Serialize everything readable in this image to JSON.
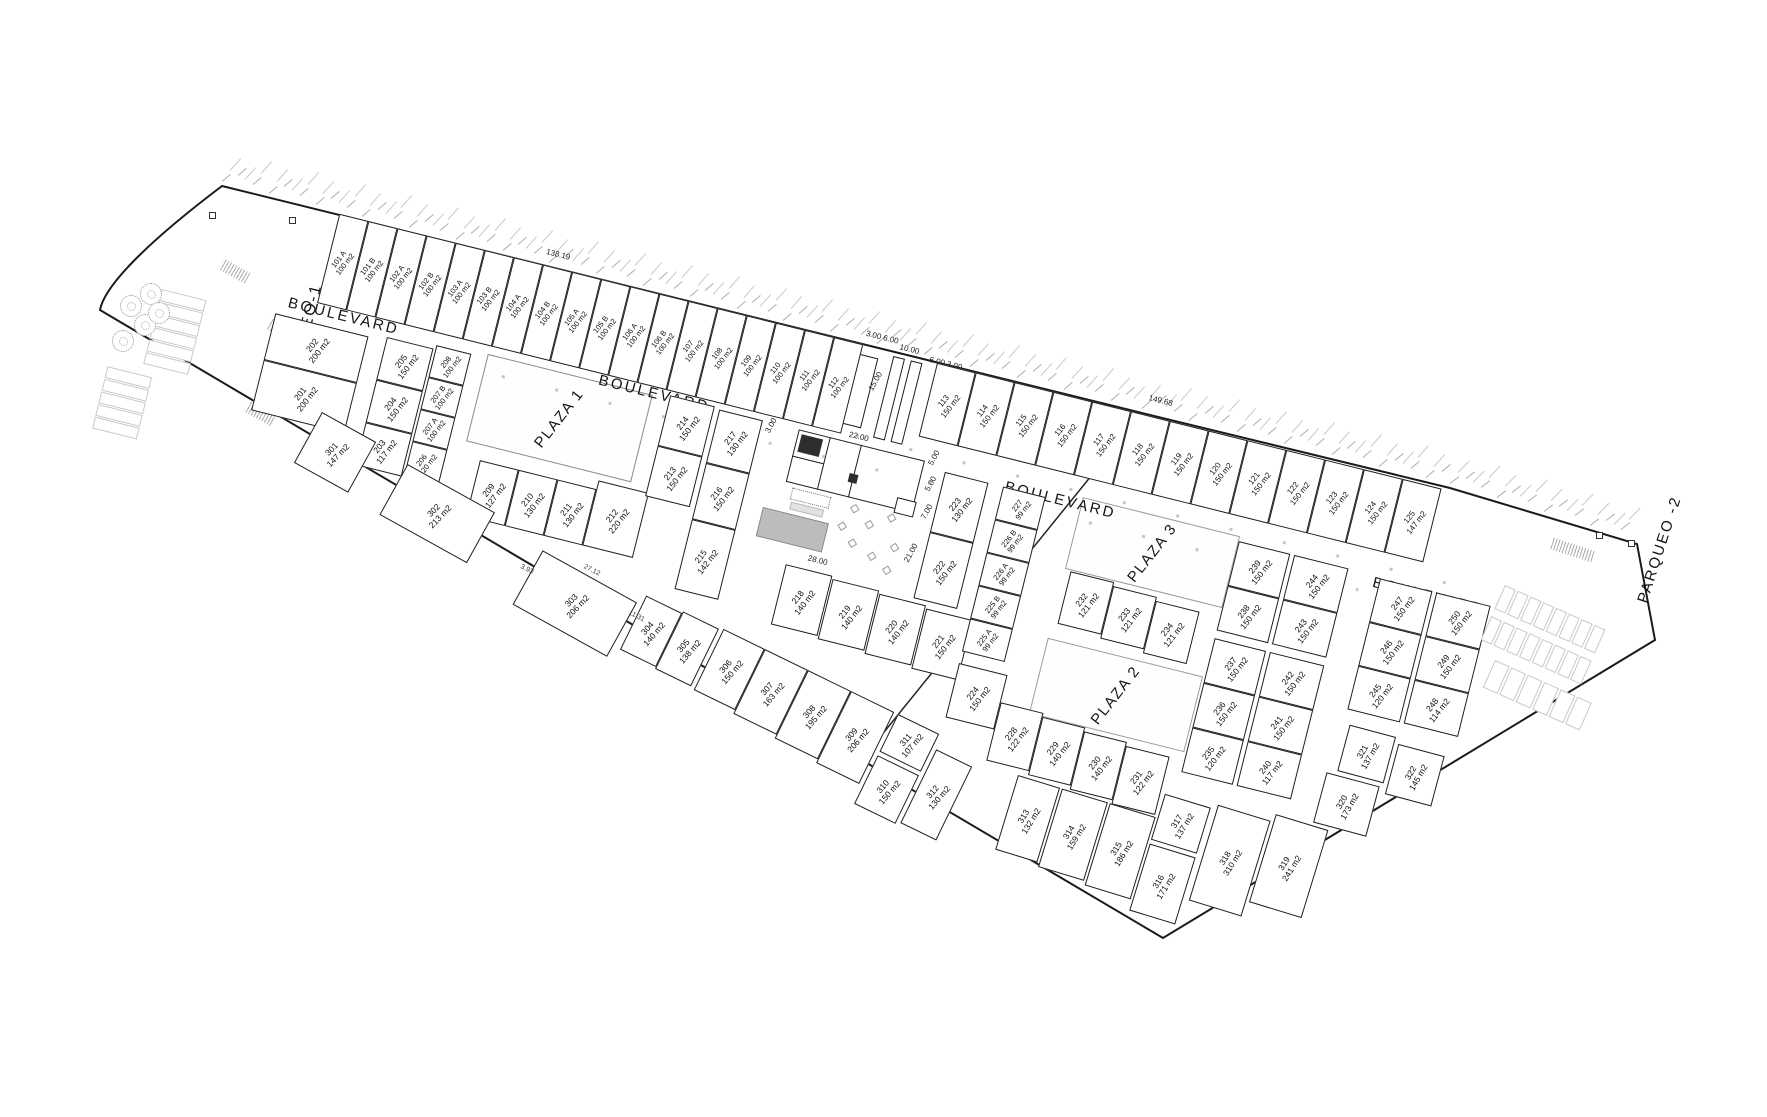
{
  "labels": {
    "parqueo1": "PARQUEO-1",
    "parqueo2": "PARQUEO -2",
    "boulevard": "BOULEVARD",
    "plaza1": "PLAZA 1",
    "plaza2": "PLAZA 2",
    "plaza3": "PLAZA 3"
  },
  "dimensions": {
    "boundary_left": "138.19",
    "boundary_right": "149.68",
    "entrance_a": "3.00 6.00",
    "entrance_b": "10.00",
    "entrance_c": "6.00 3.00",
    "entrance_depth": "15.00",
    "amenity_top": "22.00",
    "amenity_left": "3.00",
    "amenity_r1": "5.00",
    "amenity_r2": "5.00",
    "amenity_r3": "7.00",
    "amenity_r4": "21.00",
    "amenity_bottom": "28.00",
    "south_a": "3.93",
    "south_b": "27.12",
    "south_c": "11.31"
  },
  "lot_groups": {
    "north_a": [
      {
        "id": "101 A",
        "area": "100 m2"
      },
      {
        "id": "101 B",
        "area": "100 m2"
      },
      {
        "id": "102 A",
        "area": "100 m2"
      },
      {
        "id": "102 B",
        "area": "100 m2"
      },
      {
        "id": "103 A",
        "area": "100 m2"
      },
      {
        "id": "103 B",
        "area": "100 m2"
      },
      {
        "id": "104 A",
        "area": "100 m2"
      },
      {
        "id": "104 B",
        "area": "100 m2"
      },
      {
        "id": "105 A",
        "area": "100 m2"
      },
      {
        "id": "105 B",
        "area": "100 m2"
      },
      {
        "id": "106 A",
        "area": "100 m2"
      },
      {
        "id": "106 B",
        "area": "100 m2"
      },
      {
        "id": "107",
        "area": "100 m2"
      },
      {
        "id": "108",
        "area": "100 m2"
      },
      {
        "id": "109",
        "area": "100 m2"
      },
      {
        "id": "110",
        "area": "100 m2"
      },
      {
        "id": "111",
        "area": "100 m2"
      },
      {
        "id": "112",
        "area": "100 m2"
      }
    ],
    "north_b": [
      {
        "id": "113",
        "area": "150 m2"
      },
      {
        "id": "114",
        "area": "150 m2"
      },
      {
        "id": "115",
        "area": "150 m2"
      },
      {
        "id": "116",
        "area": "150 m2"
      },
      {
        "id": "117",
        "area": "150 m2"
      },
      {
        "id": "118",
        "area": "150 m2"
      },
      {
        "id": "119",
        "area": "150 m2"
      },
      {
        "id": "120",
        "area": "150 m2"
      },
      {
        "id": "121",
        "area": "150 m2"
      },
      {
        "id": "122",
        "area": "150 m2"
      },
      {
        "id": "123",
        "area": "150 m2"
      },
      {
        "id": "124",
        "area": "150 m2"
      },
      {
        "id": "125",
        "area": "147 m2"
      }
    ],
    "b201": [
      {
        "id": "202",
        "area": "200 m2"
      },
      {
        "id": "201",
        "area": "200 m2"
      }
    ],
    "b203": [
      {
        "id": "205",
        "area": "150 m2"
      },
      {
        "id": "204",
        "area": "150 m2"
      },
      {
        "id": "203",
        "area": "117 m2"
      }
    ],
    "b206": [
      {
        "id": "208",
        "area": "100 m2"
      },
      {
        "id": "207 B",
        "area": "100 m2"
      },
      {
        "id": "207 A",
        "area": "100 m2"
      },
      {
        "id": "206",
        "area": "120 m2"
      }
    ],
    "b209": [
      {
        "id": "209",
        "area": "127 m2"
      },
      {
        "id": "210",
        "area": "130 m2"
      },
      {
        "id": "211",
        "area": "130 m2"
      },
      {
        "id": "212",
        "area": "220 m2"
      }
    ],
    "b213": [
      {
        "id": "214",
        "area": "150 m2"
      },
      {
        "id": "213",
        "area": "150 m2"
      }
    ],
    "b215": [
      {
        "id": "217",
        "area": "130 m2"
      },
      {
        "id": "216",
        "area": "150 m2"
      },
      {
        "id": "215",
        "area": "142 m2"
      }
    ],
    "b218": [
      {
        "id": "218",
        "area": "140 m2"
      },
      {
        "id": "219",
        "area": "140 m2"
      },
      {
        "id": "220",
        "area": "140 m2"
      },
      {
        "id": "221",
        "area": "150 m2"
      }
    ],
    "b222": [
      {
        "id": "223",
        "area": "130 m2"
      },
      {
        "id": "222",
        "area": "150 m2"
      }
    ],
    "b225": [
      {
        "id": "227",
        "area": "99 m2"
      },
      {
        "id": "226 B",
        "area": "99 m2"
      },
      {
        "id": "226 A",
        "area": "99 m2"
      },
      {
        "id": "225 B",
        "area": "99 m2"
      },
      {
        "id": "225 A",
        "area": "99 m2"
      }
    ],
    "b224": [
      {
        "id": "224",
        "area": "150 m2"
      }
    ],
    "b228": [
      {
        "id": "228",
        "area": "122 m2"
      },
      {
        "id": "229",
        "area": "140 m2"
      },
      {
        "id": "230",
        "area": "140 m2"
      },
      {
        "id": "231",
        "area": "122 m2"
      }
    ],
    "b232": [
      {
        "id": "232",
        "area": "121 m2"
      },
      {
        "id": "233",
        "area": "121 m2"
      },
      {
        "id": "234",
        "area": "121 m2"
      }
    ],
    "b235": [
      {
        "id": "239",
        "area": "150 m2"
      },
      {
        "id": "244",
        "area": "150 m2"
      },
      {
        "id": "238",
        "area": "150 m2"
      },
      {
        "id": "243",
        "area": "150 m2"
      },
      {
        "id": "237",
        "area": "150 m2"
      },
      {
        "id": "242",
        "area": "150 m2"
      },
      {
        "id": "236",
        "area": "150 m2"
      },
      {
        "id": "241",
        "area": "150 m2"
      },
      {
        "id": "235",
        "area": "120 m2"
      },
      {
        "id": "240",
        "area": "117 m2"
      }
    ],
    "b245": [
      {
        "id": "247",
        "area": "150 m2"
      },
      {
        "id": "250",
        "area": "150 m2"
      },
      {
        "id": "246",
        "area": "150 m2"
      },
      {
        "id": "249",
        "area": "150 m2"
      },
      {
        "id": "245",
        "area": "120 m2"
      },
      {
        "id": "248",
        "area": "114 m2"
      }
    ],
    "s301": [
      {
        "id": "301",
        "area": "147 m2"
      },
      {
        "id": "302",
        "area": "213 m2"
      },
      {
        "id": "303",
        "area": "206 m2"
      }
    ],
    "s304": [
      {
        "id": "304",
        "area": "140 m2"
      },
      {
        "id": "305",
        "area": "138 m2"
      },
      {
        "id": "306",
        "area": "150 m2"
      },
      {
        "id": "307",
        "area": "163 m2"
      },
      {
        "id": "308",
        "area": "195 m2"
      },
      {
        "id": "309",
        "area": "206 m2"
      },
      {
        "id": "311",
        "area": "107 m2"
      },
      {
        "id": "310",
        "area": "150 m2"
      },
      {
        "id": "312",
        "area": "130 m2"
      }
    ],
    "s313": [
      {
        "id": "313",
        "area": "132 m2"
      },
      {
        "id": "314",
        "area": "159 m2"
      },
      {
        "id": "315",
        "area": "186 m2"
      },
      {
        "id": "317",
        "area": "137 m2"
      },
      {
        "id": "316",
        "area": "171 m2"
      },
      {
        "id": "318",
        "area": "310 m2"
      },
      {
        "id": "319",
        "area": "241 m2"
      }
    ],
    "s320": [
      {
        "id": "321",
        "area": "137 m2"
      },
      {
        "id": "322",
        "area": "145 m2"
      },
      {
        "id": "320",
        "area": "173 m2"
      }
    ]
  }
}
